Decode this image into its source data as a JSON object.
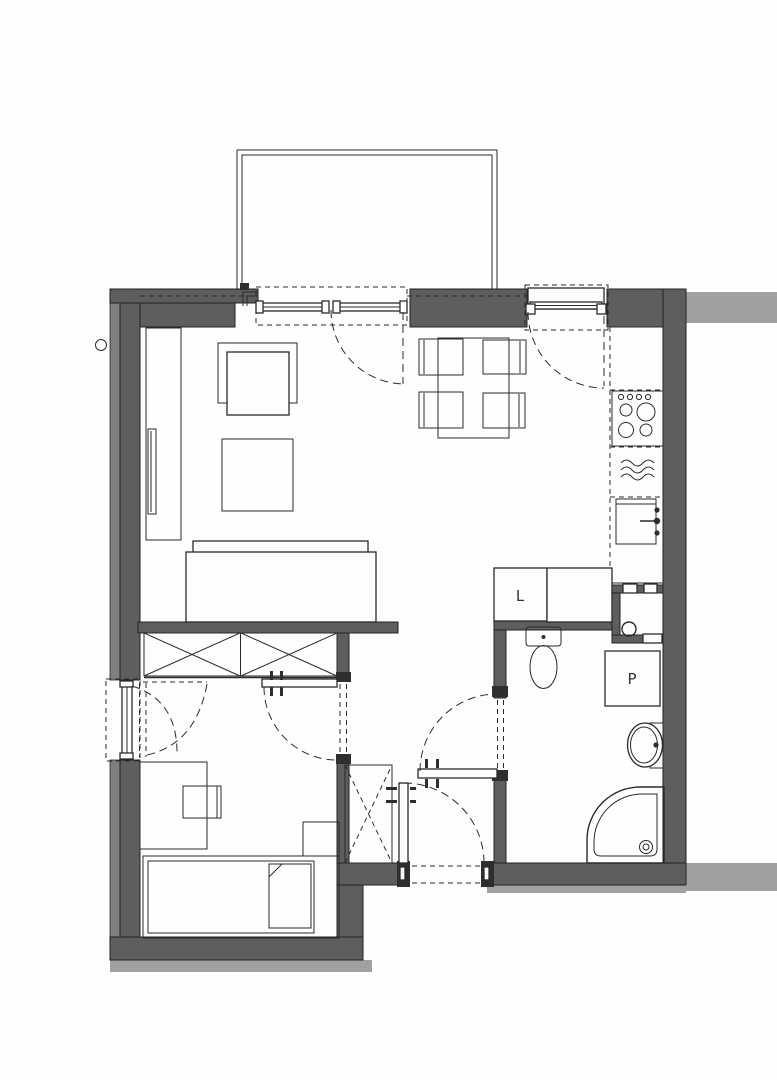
{
  "plan": {
    "title": "apartment floor plan",
    "labels": {
      "fridge": "L",
      "washing_machine": "P"
    },
    "colors": {
      "wall": "#5e5e5e",
      "wall-outer": "#7f7f7f",
      "neighbor": "#a0a0a0",
      "line": "#2b2b2b",
      "bg": "#fefefe"
    },
    "fixtures": [
      "balcony-railing",
      "sliding-balcony-door",
      "kitchen-window",
      "bedroom-window",
      "dining-table",
      "dining-chairs",
      "armchair",
      "coffee-table",
      "sofa",
      "tv-cabinet",
      "wardrobe",
      "hall-closet",
      "cooktop",
      "dishwasher",
      "kitchen-sink",
      "fridge",
      "cabinet",
      "installation-shaft",
      "toilet",
      "washing-machine",
      "washbasin",
      "shower",
      "bed",
      "pillow",
      "nightstand",
      "desk",
      "desk-chair",
      "entrance-door",
      "bathroom-door",
      "bedroom-door"
    ]
  }
}
